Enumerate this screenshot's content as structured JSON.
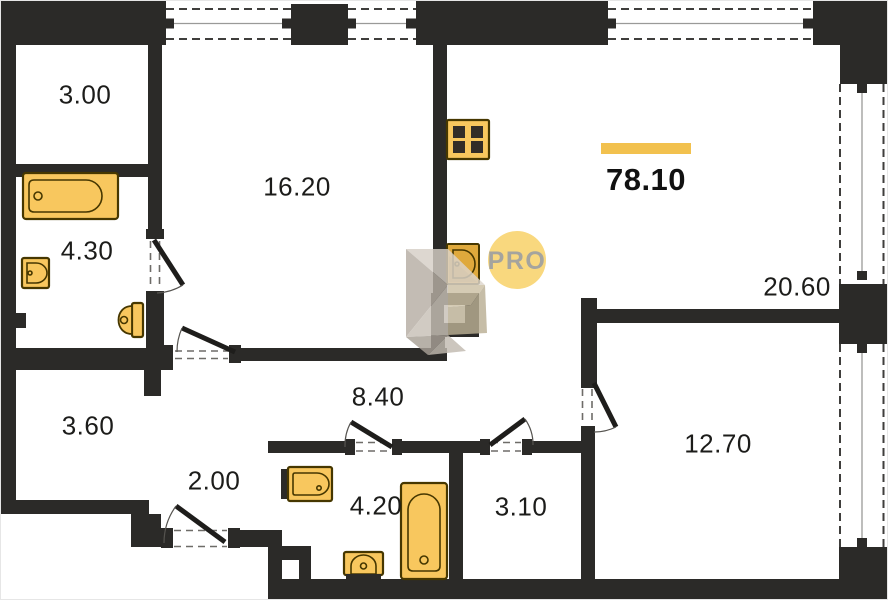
{
  "floor_plan": {
    "total": {
      "value": "78.10"
    },
    "watermark": {
      "label": "PRO"
    },
    "rooms": [
      {
        "name": "top-left-room",
        "area": "3.00"
      },
      {
        "name": "living-room",
        "area": "16.20"
      },
      {
        "name": "bathroom-main",
        "area": "4.30"
      },
      {
        "name": "kitchen-living-room",
        "area": "20.60"
      },
      {
        "name": "storage-room",
        "area": "3.60"
      },
      {
        "name": "hallway",
        "area": "8.40"
      },
      {
        "name": "entry",
        "area": "2.00"
      },
      {
        "name": "bathroom-small",
        "area": "4.20"
      },
      {
        "name": "wardrobe",
        "area": "3.10"
      },
      {
        "name": "bedroom",
        "area": "12.70"
      }
    ],
    "fixtures": [
      "bathtub-icon",
      "sink-icon",
      "toilet-icon",
      "stove-icon",
      "kitchen-sink-icon",
      "bathtub-small-icon",
      "sink-small-icon",
      "toilet-small-icon"
    ],
    "colors": {
      "wall": "#2b2a28",
      "fixture-fill": "#f8c75e",
      "fixture-stroke": "#463700",
      "accent": "#f2c14e",
      "watermark-circle": "#f9d87e",
      "watermark-text": "#a5a49e",
      "label-text": "#1c1c1a"
    }
  }
}
